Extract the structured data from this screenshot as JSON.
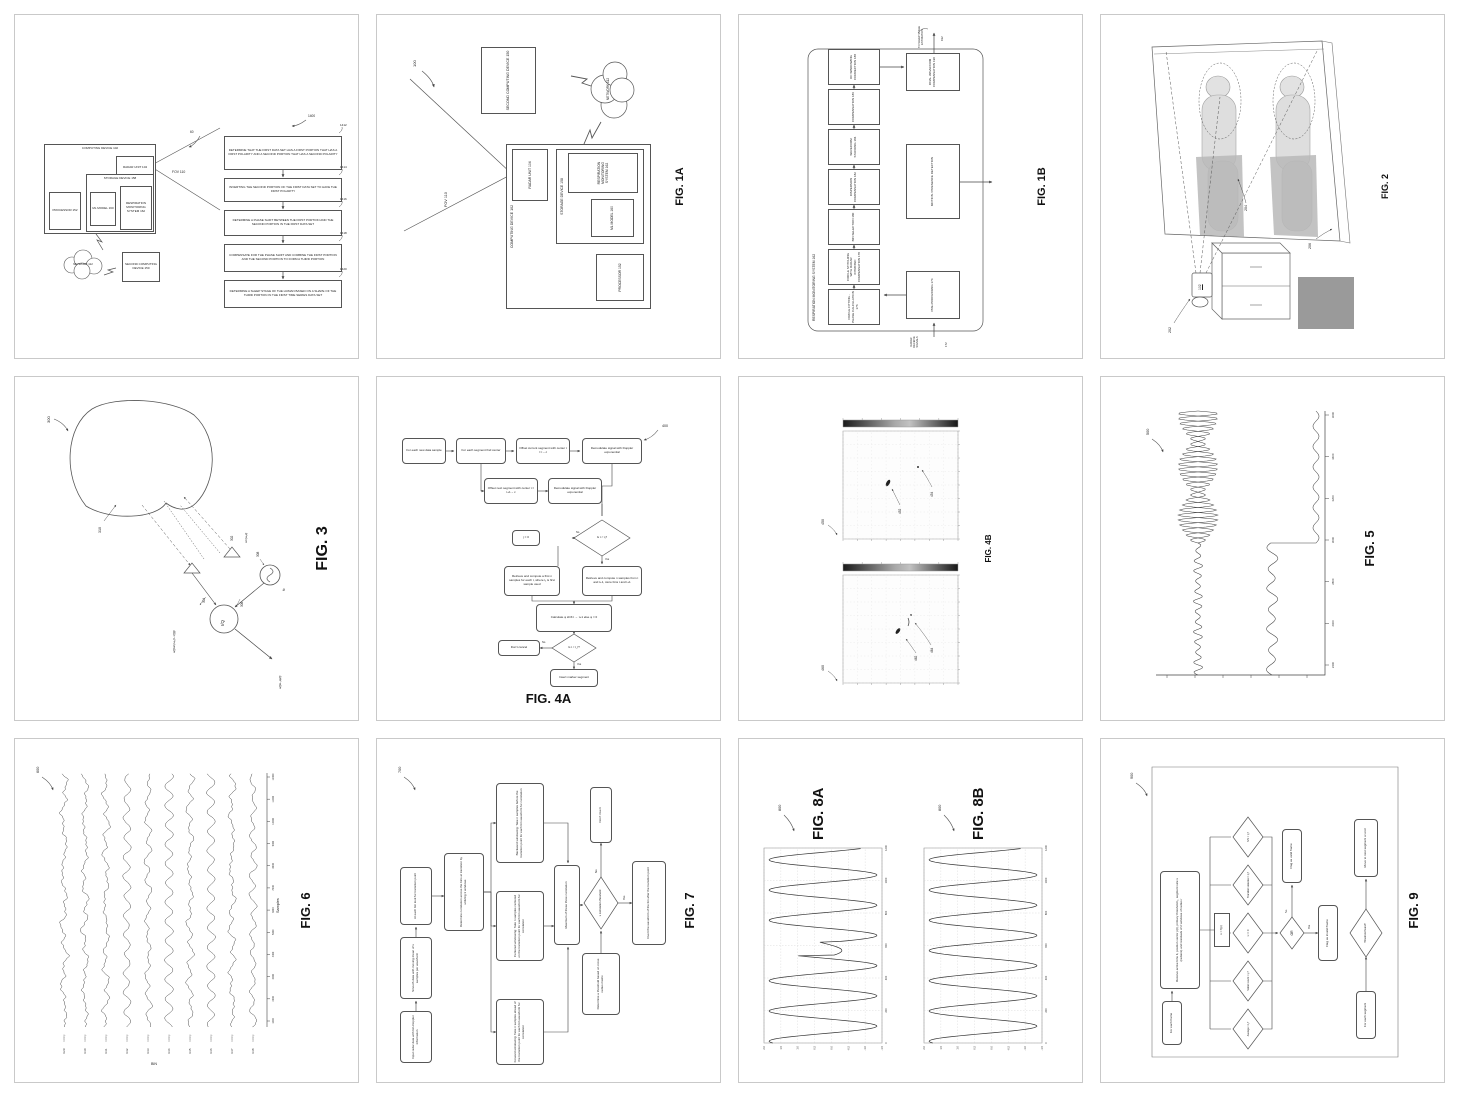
{
  "system": {
    "computing_device": "COMPUTING DEVICE 102",
    "radar_unit": "RADAR UNIT 104",
    "processor": "PROCESSOR 152",
    "storage_device": "STORAGE DEVICE 158",
    "ml_model": "ML MODEL 160",
    "respiration": "RESPIRATION MONITORING SYSTEM 162",
    "network": "NETWORK 112",
    "second_device": "SECOND COMPUTING DEVICE 150",
    "fov": "FOV 110"
  },
  "p1": {
    "ref": "60",
    "flow_ref": "1400",
    "steps": [
      {
        "num": "1412",
        "text": "DETERMINE THAT THE FIRST DATA SET HAS A FIRST PORTION THAT HAS A FIRST POLARITY AND A SECOND PORTION THAT HAS A SECOND POLARITY"
      },
      {
        "num": "1414",
        "text": "INVERTING THE SECOND PORTION OF THE FIRST DATA SET TO HAVE THE FIRST POLARITY"
      },
      {
        "num": "1416",
        "text": "DETERMINE A PHASE SHIFT BETWEEN THE FIRST PORTION AND THE SECOND PORTION IN THE FIRST DATA SET"
      },
      {
        "num": "1418",
        "text": "COMPENSATE FOR THE PHASE SHIFT AND COMBINE THE FIRST PORTION AND THE SECOND PORTION TO FORM A THIRD PORTION"
      },
      {
        "num": "1420",
        "text": "DETERMINE A SLEEP STAGE OF THE HUMAN BASED ON A SHAPE OF THE THIRD PORTION IN THE FIRST TIME SERIES DATA SET"
      }
    ]
  },
  "p2": {
    "caption": "FIG. 1A",
    "ref": "100"
  },
  "p3": {
    "caption": "FIG. 1B",
    "container": "RESPIRATION MONITORING SYSTEM 162",
    "boxes": [
      "CIRCLE FITTING - PHASE CALCULATION 176",
      "CIRCLE STITCHING WITH RADAR INTRINSIC COMPENSATION 178",
      "BIN SELECTION 180",
      "DISPERSION COMPENSATION 182",
      "WAVEFORM STACKING 184",
      "COMPENSATION 186",
      "DC WINDOWING CORRECTION 188"
    ],
    "final_box": "FINAL WAVEFORM COMPENSATION 190",
    "motion_box": "MOTION / PRESENCE DETECTION",
    "pre_box": "PRE-PROCESSING 174",
    "input_label": "RADAR RECEIVE SIGNALS",
    "input_ref": "172",
    "output_label": "TO SLEEP STAGE ESTIMATION",
    "output_ref": "192"
  },
  "p4": {
    "caption": "FIG. 2",
    "device_ref": "102",
    "lamp_ref": "202",
    "person_ref": "204",
    "bed_ref": "206"
  },
  "p5": {
    "caption": "FIG. 3",
    "ref": "300",
    "chest_ref": "310",
    "tx_ref": "302",
    "rx_ref": "304",
    "iq_ref": "306",
    "osc_ref": "308",
    "rx_eq": "a(t)sin(ω₀(t−τ(t)))",
    "tx_eq": "sin(ω₀t)",
    "out_eq": "a(t)e−jφ(t)",
    "iq": "I/Q",
    "fc": "fc"
  },
  "p6": {
    "caption": "FIG. 4A",
    "ref": "400",
    "r1": [
      "For each new data sample",
      "For each segment find center",
      "Offset current segment with center t = t − c",
      "Demodulate signal with Doppler exponential"
    ],
    "r2": [
      "Offset next segment with center t = t+1 − c",
      "Demodulate signal with Doppler exponential"
    ],
    "d1": "Is t < t₁?",
    "no1": "j = 0",
    "box_yes": "Retrieve and compute n samples from t and t+1, store bins t and t+1",
    "box_left": "Retrieve and compute a first n samples for each t, where t₁ is first sample used",
    "calc": "Calculate φ shift t → t+1 else φ = 0",
    "d2": "Is t < t_f?",
    "no2": "Don't cancel",
    "yes2": "Insert marker segment",
    "yes": "Yes",
    "no": "No"
  },
  "p7": {
    "caption": "FIG. 4B",
    "plots": [
      {
        "ref": "450",
        "l1": "452",
        "l2": "454"
      },
      {
        "ref": "460",
        "l1": "462",
        "l2": "464"
      }
    ]
  },
  "p8": {
    "caption": "FIG. 5",
    "ref": "500",
    "x_ticks": [
      2400,
      2600,
      2800,
      3000,
      3200,
      3400,
      3600
    ],
    "gen": {
      "cycles": 26,
      "step_frac": 0.5
    }
  },
  "p9": {
    "caption": "FIG. 6",
    "ref": "600",
    "xlabel": "Samples",
    "ylabel": "BIN",
    "bins": [
      "b29",
      "b30",
      "b31",
      "b32",
      "b33",
      "b34",
      "b35",
      "b36",
      "b37",
      "b38"
    ],
    "bin_sub": "InOnly",
    "x_ticks": [
      1000,
      2000,
      3000,
      4000,
      5000,
      6000,
      7000,
      8000,
      9000,
      10000,
      11000,
      12000
    ],
    "gen": {
      "mix": [
        0.25,
        0.3,
        0.35,
        0.75,
        0.5,
        0.9,
        0.45,
        0.85,
        0.35,
        0.6
      ],
      "seed": 11
    }
  },
  "p10": {
    "caption": "FIG. 7",
    "ref": "700",
    "steps": [
      "Input radar data with bin-Doppler information",
      "Smooth data with moving mean of x samples per waveform",
      "At each bin look for transition point",
      "Determine correlation across the bins at transition by utilizing 3 windows"
    ],
    "windows": [
      "Forward windowing: Take n samples ahead of the transition point for each bin waveform for correlation",
      "Centered windowing: Take n samples centered on the transition point for each bin waveform for correlation",
      "Backward windowing: Take n samples before the transition point for each bin waveform for correlation"
    ],
    "max_box": "Maximum of these three correlation",
    "thresh_box": "Determine a threshold based on cross radius matrix",
    "decision": "x correlation threshold",
    "dont": "Don't invert",
    "invert": "Invert the waveform of the bin after the transition point",
    "yes": "Yes",
    "no": "No"
  },
  "p11": {
    "caption_a": "FIG. 8A",
    "caption_b": "FIG. 8B",
    "ref": "800",
    "x_ticks": [
      0,
      200,
      400,
      600,
      800,
      1000,
      1200
    ],
    "y_ticks": [
      "2.0",
      "1.5",
      "1.0",
      "0.5",
      "0.0",
      "-0.5",
      "-1.0",
      "-1.5"
    ],
    "gen": {
      "amp": 1.6,
      "offset": 0.25,
      "period": 186,
      "phase": 1.2,
      "anomaly": [
        540,
        625
      ],
      "x_max": 1200,
      "y_top": 2.0,
      "y_bot": -1.5
    }
  },
  "p12": {
    "caption": "FIG. 9",
    "ref": "900",
    "start": "For each frame",
    "receive": "Receive active bins b, position vector p(t), primary threshold t₁, segment size s (radians) and residuals of 2 windows of radius r",
    "fx": "x = f(p)",
    "diamonds": [
      "Average > t₁?",
      "Motion count > t₂?",
      "x == 0",
      "Transition detected > t₃?",
      "S/N > t₄?"
    ],
    "or": "OR",
    "valid": "Flag as valid frame",
    "invalid": "Flag as invalid frame",
    "seg": "For each segment",
    "found": "Threshold found?",
    "move": "Move to next segment or end",
    "yes": "Yes",
    "no": "No"
  }
}
